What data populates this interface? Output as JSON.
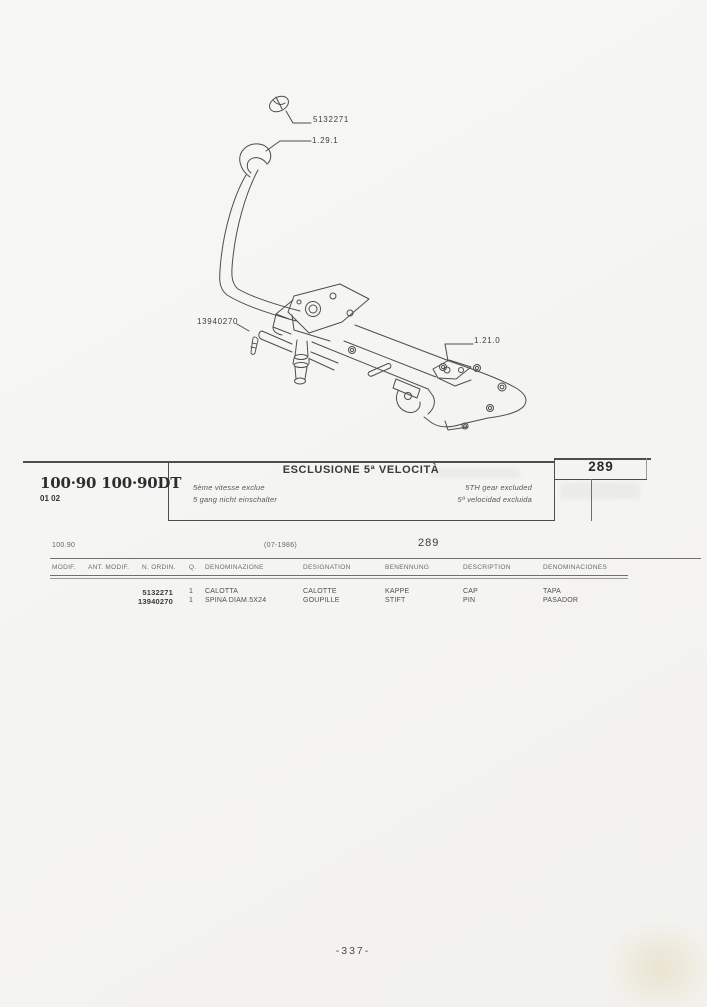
{
  "header": {
    "models": "100·90 100·90DT",
    "modif_codes": "01 02",
    "title": "ESCLUSIONE 5ª VELOCITÀ",
    "subtitle_fr": "5ème vitesse exclue",
    "subtitle_de": "5 gang nicht einschalter",
    "subtitle_en": "5TH gear excluded",
    "subtitle_es": "5ª velocidad excluida",
    "page_ref": "289"
  },
  "diagram": {
    "callouts": [
      {
        "label": "5132271"
      },
      {
        "label": "1.29.1"
      },
      {
        "label": "13940270"
      },
      {
        "label": "1.21.0"
      }
    ]
  },
  "table": {
    "model_code": "100.90",
    "date_code": "(07-1986)",
    "page_ref": "289",
    "columns": [
      "MODIF.",
      "ANT. MODIF.",
      "N. ORDIN.",
      "Q.",
      "DENOMINAZIONE",
      "DESIGNATION",
      "BENENNUNG",
      "DESCRIPTION",
      "DENOMINACIONES"
    ],
    "rows": [
      {
        "part_number": "5132271",
        "qty": "1",
        "denominazione": "CALOTTA",
        "designation": "CALOTTE",
        "benennung": "KAPPE",
        "description": "CAP",
        "denominaciones": "TAPA"
      },
      {
        "part_number": "13940270",
        "qty": "1",
        "denominazione": "SPINA DIAM.5X24",
        "designation": "GOUPILLE",
        "benennung": "STIFT",
        "description": "PIN",
        "denominaciones": "PASADOR"
      }
    ]
  },
  "footer": {
    "page_number": "-337-"
  }
}
